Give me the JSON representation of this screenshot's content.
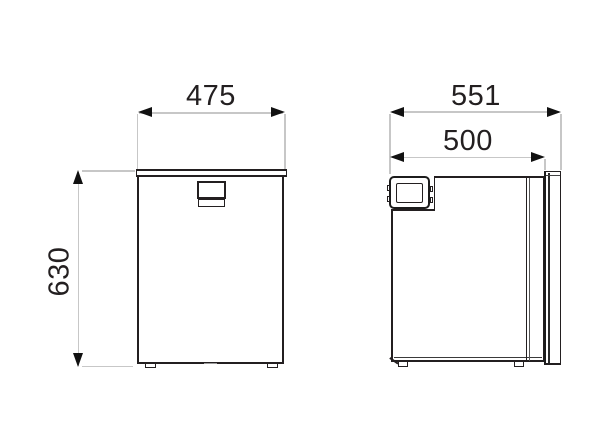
{
  "drawing": {
    "type": "appliance-dimension-drawing",
    "views": {
      "front": {
        "name": "front view",
        "width_label": "475",
        "height_label": "630"
      },
      "side": {
        "name": "side view",
        "total_depth_label": "551",
        "body_depth_label": "500"
      }
    },
    "colors": {
      "outline": "#231f20",
      "dimension_line": "#c7c7c7",
      "arrow": "#111111",
      "background": "#ffffff"
    }
  }
}
